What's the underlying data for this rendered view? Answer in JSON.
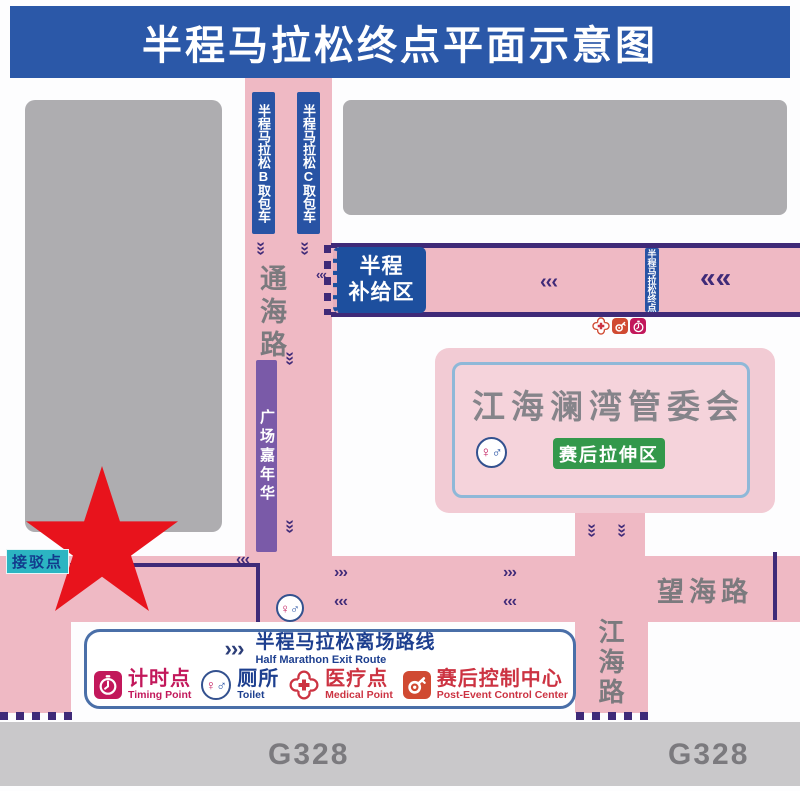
{
  "title": "半程马拉松终点平面示意图",
  "roads": {
    "tonghai": "通海路",
    "wanghai": "望海路",
    "jianghai": "江海路",
    "g328": "G328"
  },
  "labels": {
    "bag_b": "半程马拉松B取包车",
    "bag_c": "半程马拉松C取包车",
    "supply_1": "半程",
    "supply_2": "补给区",
    "finish_strip": "半程马拉松终点",
    "carnival": "广场嘉年华",
    "committee": "江海澜湾管委会",
    "stretch_zone": "赛后拉伸区",
    "shuttle_point": "接驳点"
  },
  "legend": {
    "route_cn": "半程马拉松离场路线",
    "route_en": "Half Marathon Exit Route",
    "items": [
      {
        "cn": "计时点",
        "en": "Timing Point"
      },
      {
        "cn": "厕所",
        "en": "Toilet"
      },
      {
        "cn": "医疗点",
        "en": "Medical Point"
      },
      {
        "cn": "赛后控制中心",
        "en": "Post-Event Control Center"
      }
    ]
  },
  "icons": {
    "chev_left": "‹‹‹",
    "chev_right": "›››",
    "chev_left_big": "««",
    "female": "♀",
    "male": "♂"
  },
  "colors": {
    "header_blue": "#2b58a8",
    "road_pink": "#efb9c4",
    "border_purple": "#3f2a78",
    "strip_blue": "#2853a4",
    "supply_blue": "#1d4f9e",
    "carnival_purple": "#7a5aa8",
    "building_gray": "#aeadb0",
    "star_red": "#e8131c",
    "shuttle_teal": "#2cb5c2",
    "stretch_green": "#33984b",
    "timing_magenta": "#c2185b",
    "medical_red": "#cc3342",
    "control_red": "#d04a32",
    "g328_gray": "#c9c8ca"
  }
}
